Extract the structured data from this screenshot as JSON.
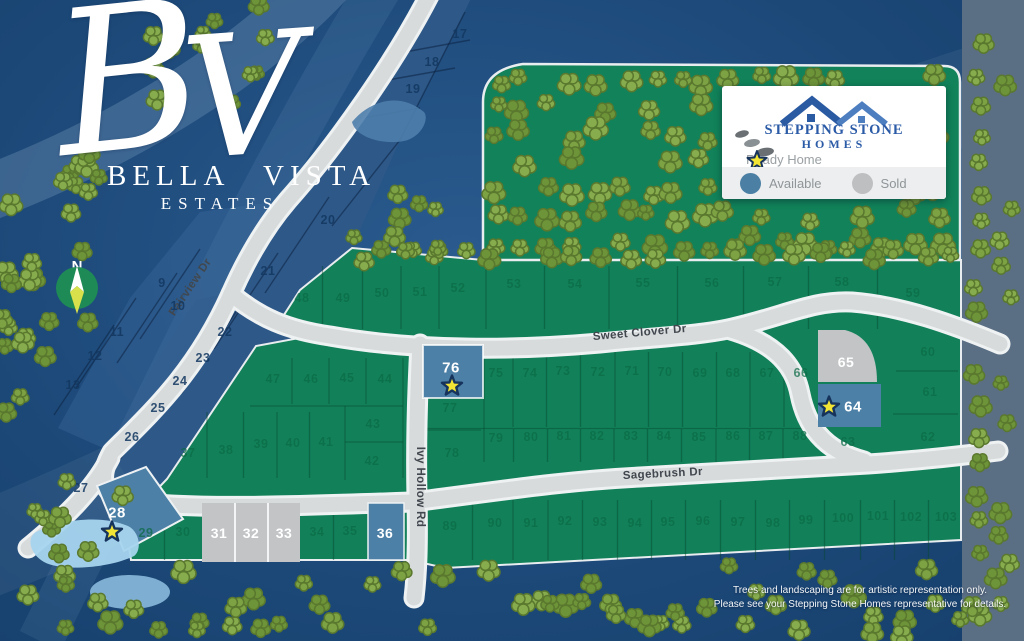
{
  "brand": {
    "script_b": "B",
    "script_v": "V",
    "word1": "BELLA",
    "word2": "VISTA",
    "subtitle": "ESTATES"
  },
  "compass": {
    "north": "N"
  },
  "legend": {
    "company_line1": "STEPPING STONE",
    "company_line2": "HOMES",
    "ready_label": "Ready Home",
    "available_label": "Available",
    "sold_label": "Sold"
  },
  "disclaimer": {
    "line1": "Trees and landscaping are for artistic representation only.",
    "line2": "Please see your Stepping Stone Homes representative for details."
  },
  "colors": {
    "background": "#1d4a7a",
    "plat_green": "#12815a",
    "available_blue": "#4c80a6",
    "sold_gray": "#c2c4c6",
    "road_gray": "#d8dbdc",
    "road_edge": "#eff2f3",
    "star_yellow": "#f2e435",
    "star_outline": "#16335c",
    "tree_greens": [
      "#7ca244",
      "#6e9439",
      "#87ac4e"
    ],
    "tree_outline": "#5a782e",
    "green_label": "#0b6b46",
    "blue_label": "#133861",
    "white_label": "#ffffff",
    "road_label": "#41474e",
    "pond_blue": "#a6d4ee",
    "legend_available": "#4b7fa3",
    "legend_sold": "#bdbfc1"
  },
  "roads": [
    {
      "name": "Fairview Dr",
      "x": 193,
      "y": 289,
      "r": -56
    },
    {
      "name": "Sweet Clover Dr",
      "x": 640,
      "y": 336,
      "r": -5
    },
    {
      "name": "Sagebrush Dr",
      "x": 663,
      "y": 477,
      "r": -3
    },
    {
      "name": "Ivy Hollow Rd",
      "x": 417,
      "y": 487,
      "r": 90
    }
  ],
  "parcels": [
    {
      "n": "9",
      "x": 162,
      "y": 283,
      "t": "b"
    },
    {
      "n": "10",
      "x": 178,
      "y": 306,
      "t": "b"
    },
    {
      "n": "11",
      "x": 117,
      "y": 332,
      "t": "b"
    },
    {
      "n": "12",
      "x": 95,
      "y": 356,
      "t": "b"
    },
    {
      "n": "13",
      "x": 73,
      "y": 385,
      "t": "b"
    },
    {
      "n": "17",
      "x": 460,
      "y": 34,
      "t": "b"
    },
    {
      "n": "18",
      "x": 432,
      "y": 62,
      "t": "b"
    },
    {
      "n": "19",
      "x": 413,
      "y": 89,
      "t": "b"
    },
    {
      "n": "20",
      "x": 328,
      "y": 220,
      "t": "b"
    },
    {
      "n": "21",
      "x": 268,
      "y": 271,
      "t": "b"
    },
    {
      "n": "22",
      "x": 225,
      "y": 332,
      "t": "b"
    },
    {
      "n": "23",
      "x": 203,
      "y": 358,
      "t": "b"
    },
    {
      "n": "24",
      "x": 180,
      "y": 381,
      "t": "b"
    },
    {
      "n": "25",
      "x": 158,
      "y": 408,
      "t": "b"
    },
    {
      "n": "26",
      "x": 132,
      "y": 437,
      "t": "b"
    },
    {
      "n": "27",
      "x": 81,
      "y": 488,
      "t": "b"
    },
    {
      "n": "29",
      "x": 146,
      "y": 533,
      "t": "g"
    },
    {
      "n": "30",
      "x": 183,
      "y": 532,
      "t": "g"
    },
    {
      "n": "34",
      "x": 317,
      "y": 532,
      "t": "g"
    },
    {
      "n": "35",
      "x": 350,
      "y": 531,
      "t": "g"
    },
    {
      "n": "37",
      "x": 188,
      "y": 453,
      "t": "g"
    },
    {
      "n": "38",
      "x": 226,
      "y": 450,
      "t": "g"
    },
    {
      "n": "39",
      "x": 261,
      "y": 444,
      "t": "g"
    },
    {
      "n": "40",
      "x": 293,
      "y": 443,
      "t": "g"
    },
    {
      "n": "41",
      "x": 326,
      "y": 442,
      "t": "g"
    },
    {
      "n": "42",
      "x": 372,
      "y": 461,
      "t": "g"
    },
    {
      "n": "43",
      "x": 373,
      "y": 424,
      "t": "g"
    },
    {
      "n": "44",
      "x": 385,
      "y": 379,
      "t": "g"
    },
    {
      "n": "45",
      "x": 347,
      "y": 378,
      "t": "g"
    },
    {
      "n": "46",
      "x": 311,
      "y": 379,
      "t": "g"
    },
    {
      "n": "47",
      "x": 273,
      "y": 379,
      "t": "g"
    },
    {
      "n": "48",
      "x": 302,
      "y": 298,
      "t": "g"
    },
    {
      "n": "49",
      "x": 343,
      "y": 298,
      "t": "g"
    },
    {
      "n": "50",
      "x": 382,
      "y": 293,
      "t": "g"
    },
    {
      "n": "51",
      "x": 420,
      "y": 292,
      "t": "g"
    },
    {
      "n": "52",
      "x": 458,
      "y": 288,
      "t": "g"
    },
    {
      "n": "53",
      "x": 514,
      "y": 284,
      "t": "g"
    },
    {
      "n": "54",
      "x": 575,
      "y": 284,
      "t": "g"
    },
    {
      "n": "55",
      "x": 643,
      "y": 283,
      "t": "g"
    },
    {
      "n": "56",
      "x": 712,
      "y": 283,
      "t": "g"
    },
    {
      "n": "57",
      "x": 775,
      "y": 282,
      "t": "g"
    },
    {
      "n": "58",
      "x": 842,
      "y": 282,
      "t": "g"
    },
    {
      "n": "59",
      "x": 913,
      "y": 293,
      "t": "g"
    },
    {
      "n": "60",
      "x": 928,
      "y": 352,
      "t": "g"
    },
    {
      "n": "61",
      "x": 930,
      "y": 392,
      "t": "g"
    },
    {
      "n": "62",
      "x": 928,
      "y": 437,
      "t": "g"
    },
    {
      "n": "63",
      "x": 848,
      "y": 442,
      "t": "g"
    },
    {
      "n": "66",
      "x": 801,
      "y": 373,
      "t": "g"
    },
    {
      "n": "67",
      "x": 767,
      "y": 373,
      "t": "g"
    },
    {
      "n": "68",
      "x": 733,
      "y": 373,
      "t": "g"
    },
    {
      "n": "69",
      "x": 700,
      "y": 373,
      "t": "g"
    },
    {
      "n": "70",
      "x": 665,
      "y": 372,
      "t": "g"
    },
    {
      "n": "71",
      "x": 632,
      "y": 371,
      "t": "g"
    },
    {
      "n": "72",
      "x": 598,
      "y": 372,
      "t": "g"
    },
    {
      "n": "73",
      "x": 563,
      "y": 371,
      "t": "g"
    },
    {
      "n": "74",
      "x": 530,
      "y": 373,
      "t": "g"
    },
    {
      "n": "75",
      "x": 496,
      "y": 373,
      "t": "g"
    },
    {
      "n": "77",
      "x": 450,
      "y": 408,
      "t": "g"
    },
    {
      "n": "78",
      "x": 452,
      "y": 453,
      "t": "g"
    },
    {
      "n": "79",
      "x": 496,
      "y": 438,
      "t": "g"
    },
    {
      "n": "80",
      "x": 531,
      "y": 437,
      "t": "g"
    },
    {
      "n": "81",
      "x": 564,
      "y": 436,
      "t": "g"
    },
    {
      "n": "82",
      "x": 597,
      "y": 436,
      "t": "g"
    },
    {
      "n": "83",
      "x": 631,
      "y": 436,
      "t": "g"
    },
    {
      "n": "84",
      "x": 664,
      "y": 436,
      "t": "g"
    },
    {
      "n": "85",
      "x": 699,
      "y": 437,
      "t": "g"
    },
    {
      "n": "86",
      "x": 733,
      "y": 436,
      "t": "g"
    },
    {
      "n": "87",
      "x": 766,
      "y": 436,
      "t": "g"
    },
    {
      "n": "88",
      "x": 800,
      "y": 436,
      "t": "g"
    },
    {
      "n": "89",
      "x": 450,
      "y": 526,
      "t": "g"
    },
    {
      "n": "90",
      "x": 495,
      "y": 523,
      "t": "g"
    },
    {
      "n": "91",
      "x": 531,
      "y": 523,
      "t": "g"
    },
    {
      "n": "92",
      "x": 565,
      "y": 521,
      "t": "g"
    },
    {
      "n": "93",
      "x": 600,
      "y": 522,
      "t": "g"
    },
    {
      "n": "94",
      "x": 635,
      "y": 523,
      "t": "g"
    },
    {
      "n": "95",
      "x": 668,
      "y": 522,
      "t": "g"
    },
    {
      "n": "96",
      "x": 703,
      "y": 521,
      "t": "g"
    },
    {
      "n": "97",
      "x": 738,
      "y": 522,
      "t": "g"
    },
    {
      "n": "98",
      "x": 773,
      "y": 523,
      "t": "g"
    },
    {
      "n": "99",
      "x": 806,
      "y": 520,
      "t": "g"
    },
    {
      "n": "100",
      "x": 843,
      "y": 518,
      "t": "g"
    },
    {
      "n": "101",
      "x": 878,
      "y": 516,
      "t": "g"
    },
    {
      "n": "102",
      "x": 911,
      "y": 517,
      "t": "g"
    },
    {
      "n": "103",
      "x": 946,
      "y": 517,
      "t": "g"
    },
    {
      "n": "31",
      "x": 219,
      "y": 533,
      "t": "s"
    },
    {
      "n": "32",
      "x": 251,
      "y": 533,
      "t": "s"
    },
    {
      "n": "33",
      "x": 284,
      "y": 533,
      "t": "s"
    },
    {
      "n": "65",
      "x": 846,
      "y": 362,
      "t": "s"
    },
    {
      "n": "36",
      "x": 385,
      "y": 533,
      "t": "a"
    },
    {
      "n": "28",
      "x": 117,
      "y": 513,
      "t": "r",
      "sx": 112,
      "sy": 532
    },
    {
      "n": "64",
      "x": 853,
      "y": 407,
      "t": "r",
      "sx": 829,
      "sy": 407
    },
    {
      "n": "76",
      "x": 451,
      "y": 368,
      "t": "r",
      "sx": 452,
      "sy": 386
    }
  ]
}
